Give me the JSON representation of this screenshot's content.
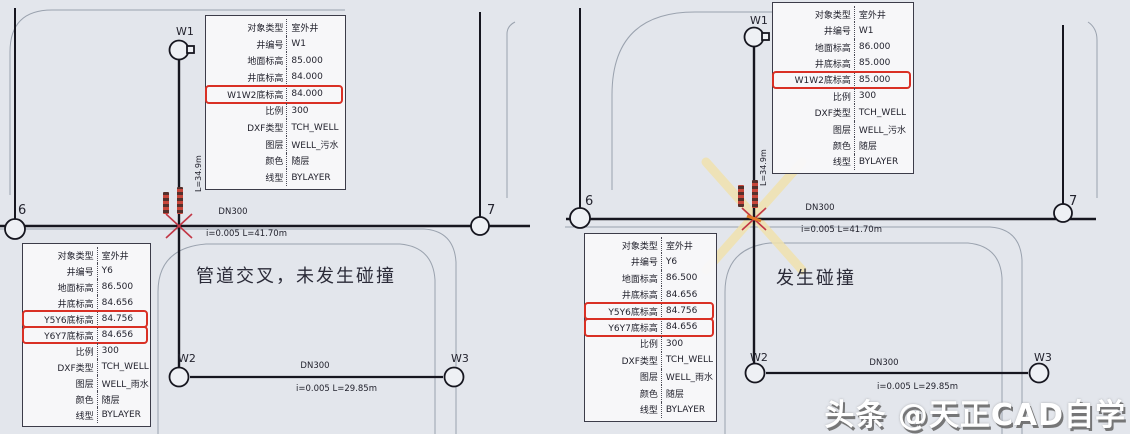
{
  "colors": {
    "background": "#e3e6ec",
    "pipe": "#16161f",
    "road": "#9aa2ae",
    "highlight_red": "#d93025",
    "collision_marker_red": "#c23645",
    "collision_flag_yellow": "#f0e2ae",
    "text": "#23232e"
  },
  "watermark": {
    "text": "头条 @天正CAD自学"
  },
  "panels": {
    "left": {
      "caption": "管道交叉，未发生碰撞",
      "well_labels": {
        "w1": "W1",
        "w2": "W2",
        "w3": "W3",
        "y6": "6",
        "y7": "7"
      },
      "pipes": {
        "main_dn": "DN300",
        "main_spec": "i=0.005 L=41.70m",
        "bottom_dn": "DN300",
        "bottom_spec": "i=0.005 L=29.85m",
        "vertical_len": "L=34.9m"
      },
      "info_top": {
        "rows": [
          {
            "label": "对象类型",
            "value": "室外井"
          },
          {
            "label": "井编号",
            "value": "W1"
          },
          {
            "label": "地面标高",
            "value": "85.000"
          },
          {
            "label": "井底标高",
            "value": "84.000"
          },
          {
            "label": "W1W2底标高",
            "value": "84.000",
            "highlight": true
          },
          {
            "label": "比例",
            "value": "300"
          },
          {
            "label": "DXF类型",
            "value": "TCH_WELL"
          },
          {
            "label": "图层",
            "value": "WELL_污水"
          },
          {
            "label": "颜色",
            "value": "随层"
          },
          {
            "label": "线型",
            "value": "BYLAYER"
          }
        ]
      },
      "info_bottom": {
        "rows": [
          {
            "label": "对象类型",
            "value": "室外井"
          },
          {
            "label": "井编号",
            "value": "Y6"
          },
          {
            "label": "地面标高",
            "value": "86.500"
          },
          {
            "label": "井底标高",
            "value": "84.656"
          },
          {
            "label": "Y5Y6底标高",
            "value": "84.756",
            "highlight": true
          },
          {
            "label": "Y6Y7底标高",
            "value": "84.656",
            "highlight": true
          },
          {
            "label": "比例",
            "value": "300"
          },
          {
            "label": "DXF类型",
            "value": "TCH_WELL"
          },
          {
            "label": "图层",
            "value": "WELL_雨水"
          },
          {
            "label": "颜色",
            "value": "随层"
          },
          {
            "label": "线型",
            "value": "BYLAYER"
          }
        ]
      }
    },
    "right": {
      "caption": "发生碰撞",
      "well_labels": {
        "w1": "W1",
        "w2": "W2",
        "w3": "W3",
        "y6": "6",
        "y7": "7"
      },
      "pipes": {
        "main_dn": "DN300",
        "main_spec": "i=0.005 L=41.70m",
        "bottom_dn": "DN300",
        "bottom_spec": "i=0.005 L=29.85m",
        "vertical_len": "L=34.9m"
      },
      "info_top": {
        "rows": [
          {
            "label": "对象类型",
            "value": "室外井"
          },
          {
            "label": "井编号",
            "value": "W1"
          },
          {
            "label": "地面标高",
            "value": "86.000"
          },
          {
            "label": "井底标高",
            "value": "85.000"
          },
          {
            "label": "W1W2底标高",
            "value": "85.000",
            "highlight": true
          },
          {
            "label": "比例",
            "value": "300"
          },
          {
            "label": "DXF类型",
            "value": "TCH_WELL"
          },
          {
            "label": "图层",
            "value": "WELL_污水"
          },
          {
            "label": "颜色",
            "value": "随层"
          },
          {
            "label": "线型",
            "value": "BYLAYER"
          }
        ]
      },
      "info_bottom": {
        "rows": [
          {
            "label": "对象类型",
            "value": "室外井"
          },
          {
            "label": "井编号",
            "value": "Y6"
          },
          {
            "label": "地面标高",
            "value": "86.500"
          },
          {
            "label": "井底标高",
            "value": "84.656"
          },
          {
            "label": "Y5Y6底标高",
            "value": "84.756",
            "highlight": true
          },
          {
            "label": "Y6Y7底标高",
            "value": "84.656",
            "highlight": true
          },
          {
            "label": "比例",
            "value": "300"
          },
          {
            "label": "DXF类型",
            "value": "TCH_WELL"
          },
          {
            "label": "图层",
            "value": "WELL_雨水"
          },
          {
            "label": "颜色",
            "value": "随层"
          },
          {
            "label": "线型",
            "value": "BYLAYER"
          }
        ]
      }
    }
  }
}
